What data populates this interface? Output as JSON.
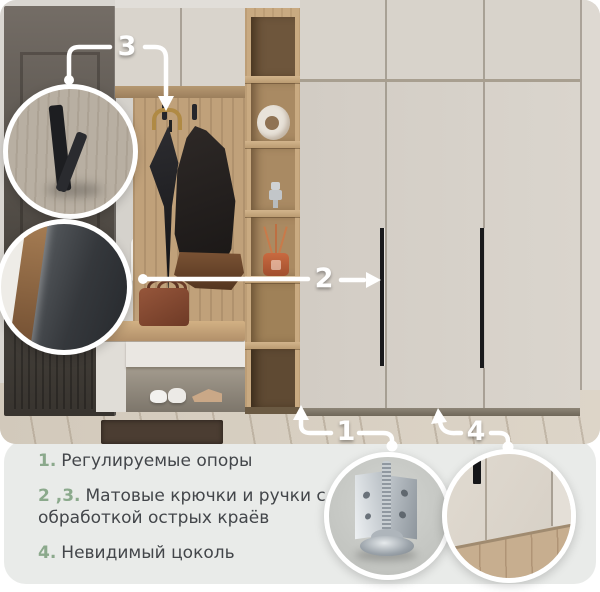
{
  "colors": {
    "accent_green": "#8BA98C",
    "panel_bg": "#E9EBE9",
    "text": "#43464A",
    "callout_white": "#FFFFFF",
    "wardrobe_cream": "#D8D3CB",
    "wood_oak": "#C0A17A"
  },
  "callouts": {
    "c1": {
      "number": "1",
      "target": "adjustable-supports"
    },
    "c2": {
      "number": "2",
      "target": "wardrobe-door-handle"
    },
    "c3": {
      "number": "3",
      "target": "matte-hook"
    },
    "c4": {
      "number": "4",
      "target": "invisible-plinth"
    }
  },
  "features": [
    {
      "num": "1.",
      "text": "Регулируемые опоры"
    },
    {
      "num": "2 ,3.",
      "text": "Матовые крючки и ручки с обработкой острых краёв"
    },
    {
      "num": "4.",
      "text": "Невидимый цоколь"
    }
  ],
  "insets": {
    "top": "hook-closeup",
    "middle": "handle-edge-closeup",
    "bottom_left": "leveler-foot-closeup",
    "bottom_right": "plinth-closeup"
  }
}
